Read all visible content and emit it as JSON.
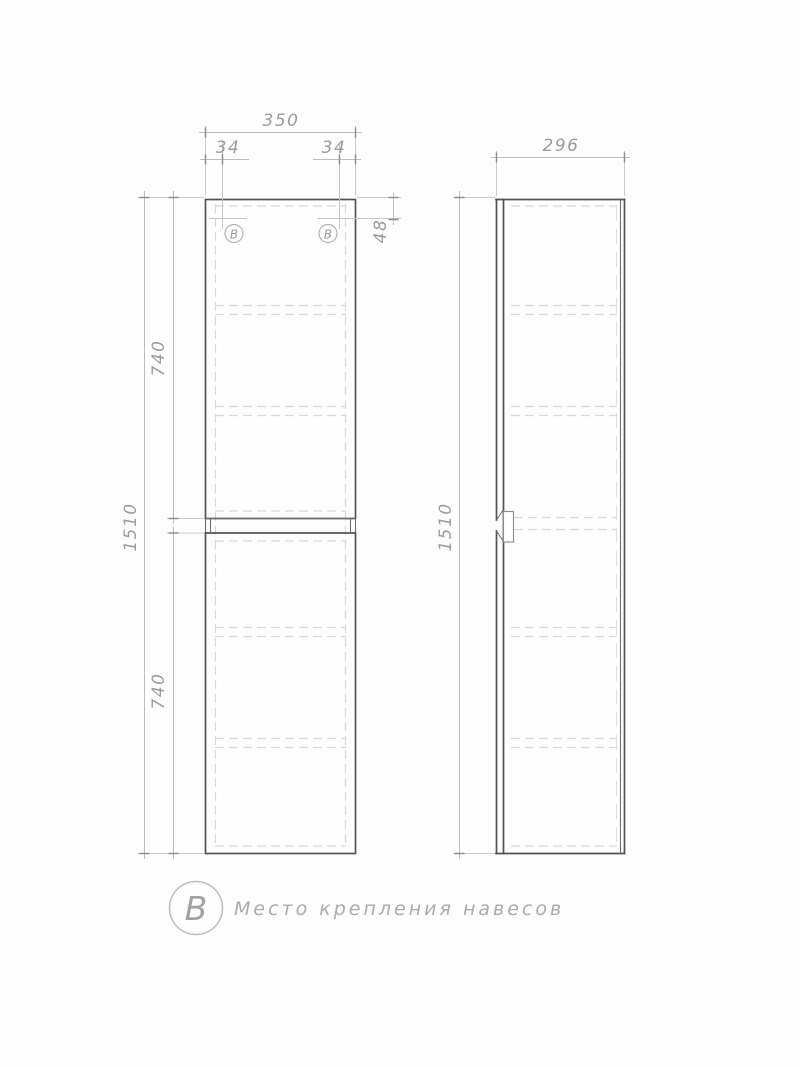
{
  "drawing": {
    "dims": {
      "front_width": "350",
      "hook_offset_left": "34",
      "hook_offset_right": "34",
      "hook_drop": "48",
      "upper_section_height": "740",
      "lower_section_height": "740",
      "total_height_front": "1510",
      "depth": "296",
      "total_height_side": "1510"
    },
    "markers": {
      "front_left": "В",
      "front_right": "В"
    },
    "legend": {
      "symbol": "В",
      "text": "Место крепления навесов"
    },
    "colors": {
      "outline": "#525252",
      "dimension": "#bdbdbd",
      "hidden": "#d9d9d9",
      "text": "#9c9c9c",
      "background": "#fdfdfd"
    }
  }
}
